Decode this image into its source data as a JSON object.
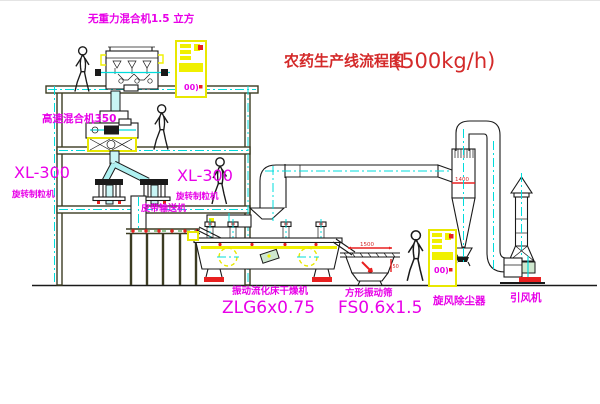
{
  "title": {
    "text": "农药生产线流程图",
    "capacity": "(500kg/h)"
  },
  "labels": {
    "top_mixer": "无重力混合机1.5 立方",
    "high_speed_mixer": "高速混合机350",
    "xl300_left": "XL-300",
    "granulator_left": "旋转制粒机",
    "xl300_mid": "XL-300",
    "granulator_mid": "旋转制粒机",
    "belt_conveyor": "皮带输送机",
    "dryer": "振动流化床干燥机",
    "dryer_model": "ZLG6x0.75",
    "screen": "方形振动筛",
    "screen_model": "FS0.6x1.5",
    "cyclone": "旋风除尘器",
    "fan": "引风机"
  },
  "dimensions": {
    "screen_width": "1500",
    "cyclone_width": "1400",
    "screen_height": "50"
  },
  "cabinet_marks": {
    "top_cabinet": "00)",
    "bottom_cabinet": "00)"
  },
  "colors": {
    "label_magenta": "#e800e8",
    "title_red": "#d42a2a",
    "equipment_yellow": "#f0f000",
    "centerline_cyan": "#00dcdc",
    "drawing_line": "#1a1a1a",
    "accent_red": "#e82020",
    "background": "#ffffff"
  }
}
